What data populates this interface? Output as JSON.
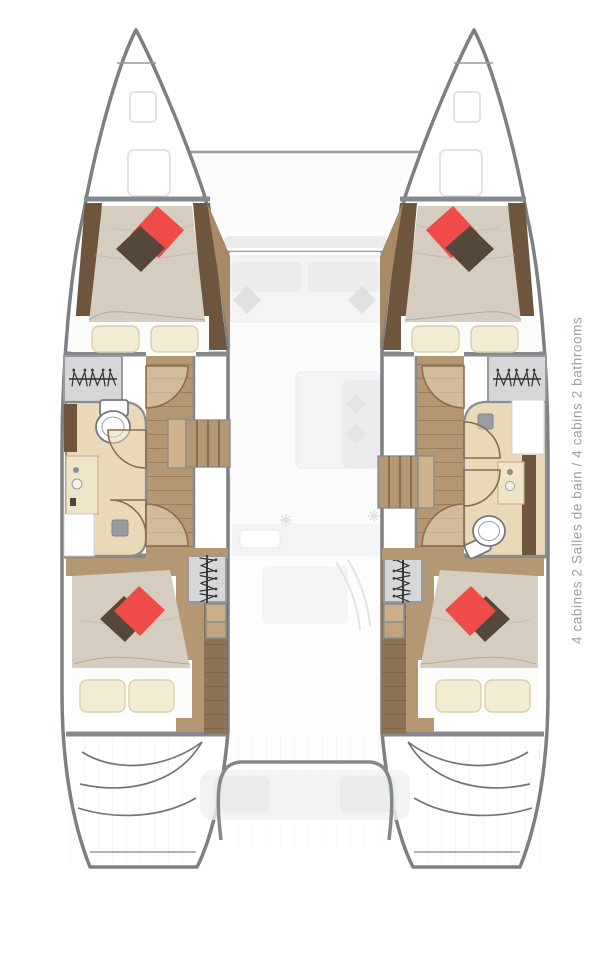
{
  "caption": {
    "text": "4 cabines 2 Salles de bain / 4 cabins 2 bathrooms"
  },
  "colors": {
    "hull_outline": "#7c8084",
    "wall": "#85888c",
    "wood_floor": "#b39873",
    "wood_floor_dark": "#8d7356",
    "wood_trim": "#6e563e",
    "mattress": "#d5cec0",
    "pillow_red": "#ef4c49",
    "pillow_brown": "#554839",
    "pillow_cream": "#f2ecd2",
    "bath_floor": "#ead9b9",
    "caption_text": "#9aa0a4"
  },
  "plan": {
    "type": "catamaran-deck-plan",
    "cabins": 4,
    "bathrooms": 2
  }
}
